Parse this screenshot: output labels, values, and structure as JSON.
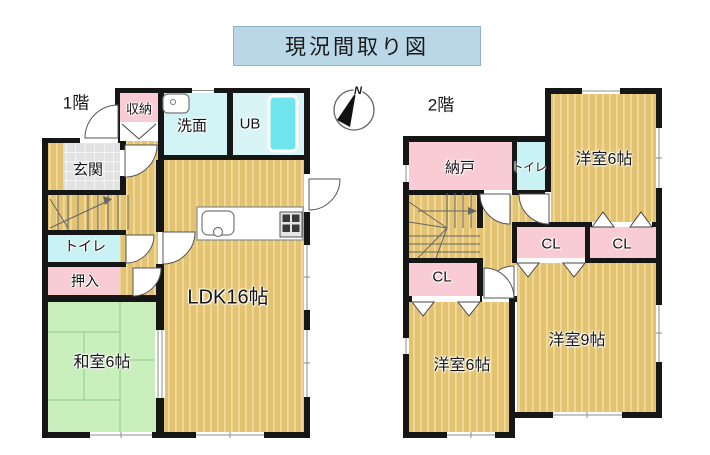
{
  "title": "現況間取り図",
  "compass": {
    "north_label": "N"
  },
  "floor1": {
    "label": "1階",
    "rooms": {
      "shuno": "収納",
      "senmen": "洗面",
      "ub": "UB",
      "genkan": "玄関",
      "toilet": "トイレ",
      "oshiire": "押入",
      "washitsu": "和室6帖",
      "ldk": "LDK16帖"
    }
  },
  "floor2": {
    "label": "2階",
    "rooms": {
      "nando": "納戸",
      "toilet": "トイレ",
      "yoshitsu6_upper": "洋室6帖",
      "cl_right": "CL",
      "cl_middle": "CL",
      "cl_left": "CL",
      "yoshitsu6_lower": "洋室6帖",
      "yoshitsu9": "洋室9帖"
    }
  },
  "colors": {
    "title_bg": "#b9d7e7",
    "wall": "#161616",
    "wood_floor": "#e3c371",
    "wood_stripe": "#f0db9b",
    "tatami_green": "#c9efbd",
    "closet_pink": "#f9ccd5",
    "wet_area_cyan": "#d2f3f6",
    "bathtub_cyan": "#6ee4ec",
    "entrance_tile": "#e2e2e2"
  }
}
